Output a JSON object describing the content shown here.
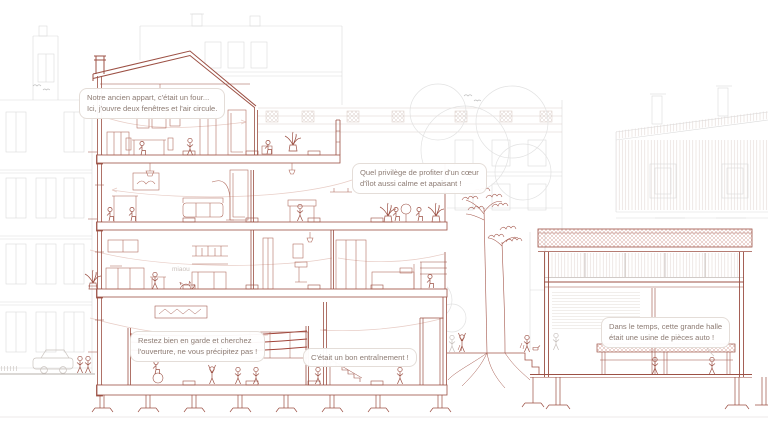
{
  "scene": {
    "type": "architectural-section-illustration",
    "language": "fr",
    "elements": [
      "apartment-building-section",
      "industrial-halle-section",
      "courtyard-with-trees",
      "background-street-facades"
    ]
  },
  "colors": {
    "section_line": "#9c5044",
    "furniture_line": "#ad6557",
    "ring_ropes": "#a04338",
    "roof_hatch": "#d6a298",
    "background_line": "#d9d9d9",
    "warm_background_line": "#d8ccc6",
    "airflow_line": "#e6cbc4",
    "bubble_text": "#8d7c74",
    "bubble_border": "#e4ddd8"
  },
  "bubbles": {
    "apartment": {
      "line1": "Notre ancien appart, c'était un four...",
      "line2": "Ici, j'ouvre deux fenêtres et l'air circule."
    },
    "courtyard": {
      "line1": "Quel privilège de profiter d'un cœur",
      "line2": "d'îlot aussi calme et apaisant !"
    },
    "guard": {
      "line1": "Restez bien en garde et cherchez",
      "line2": "l'ouverture, ne vous précipitez pas !"
    },
    "training": {
      "line1": "C'était un bon entraînement !"
    },
    "halle": {
      "line1": "Dans le temps, cette grande halle",
      "line2": "était une usine de pièces auto !"
    }
  },
  "labels": {
    "cat_sound": "miaou"
  }
}
